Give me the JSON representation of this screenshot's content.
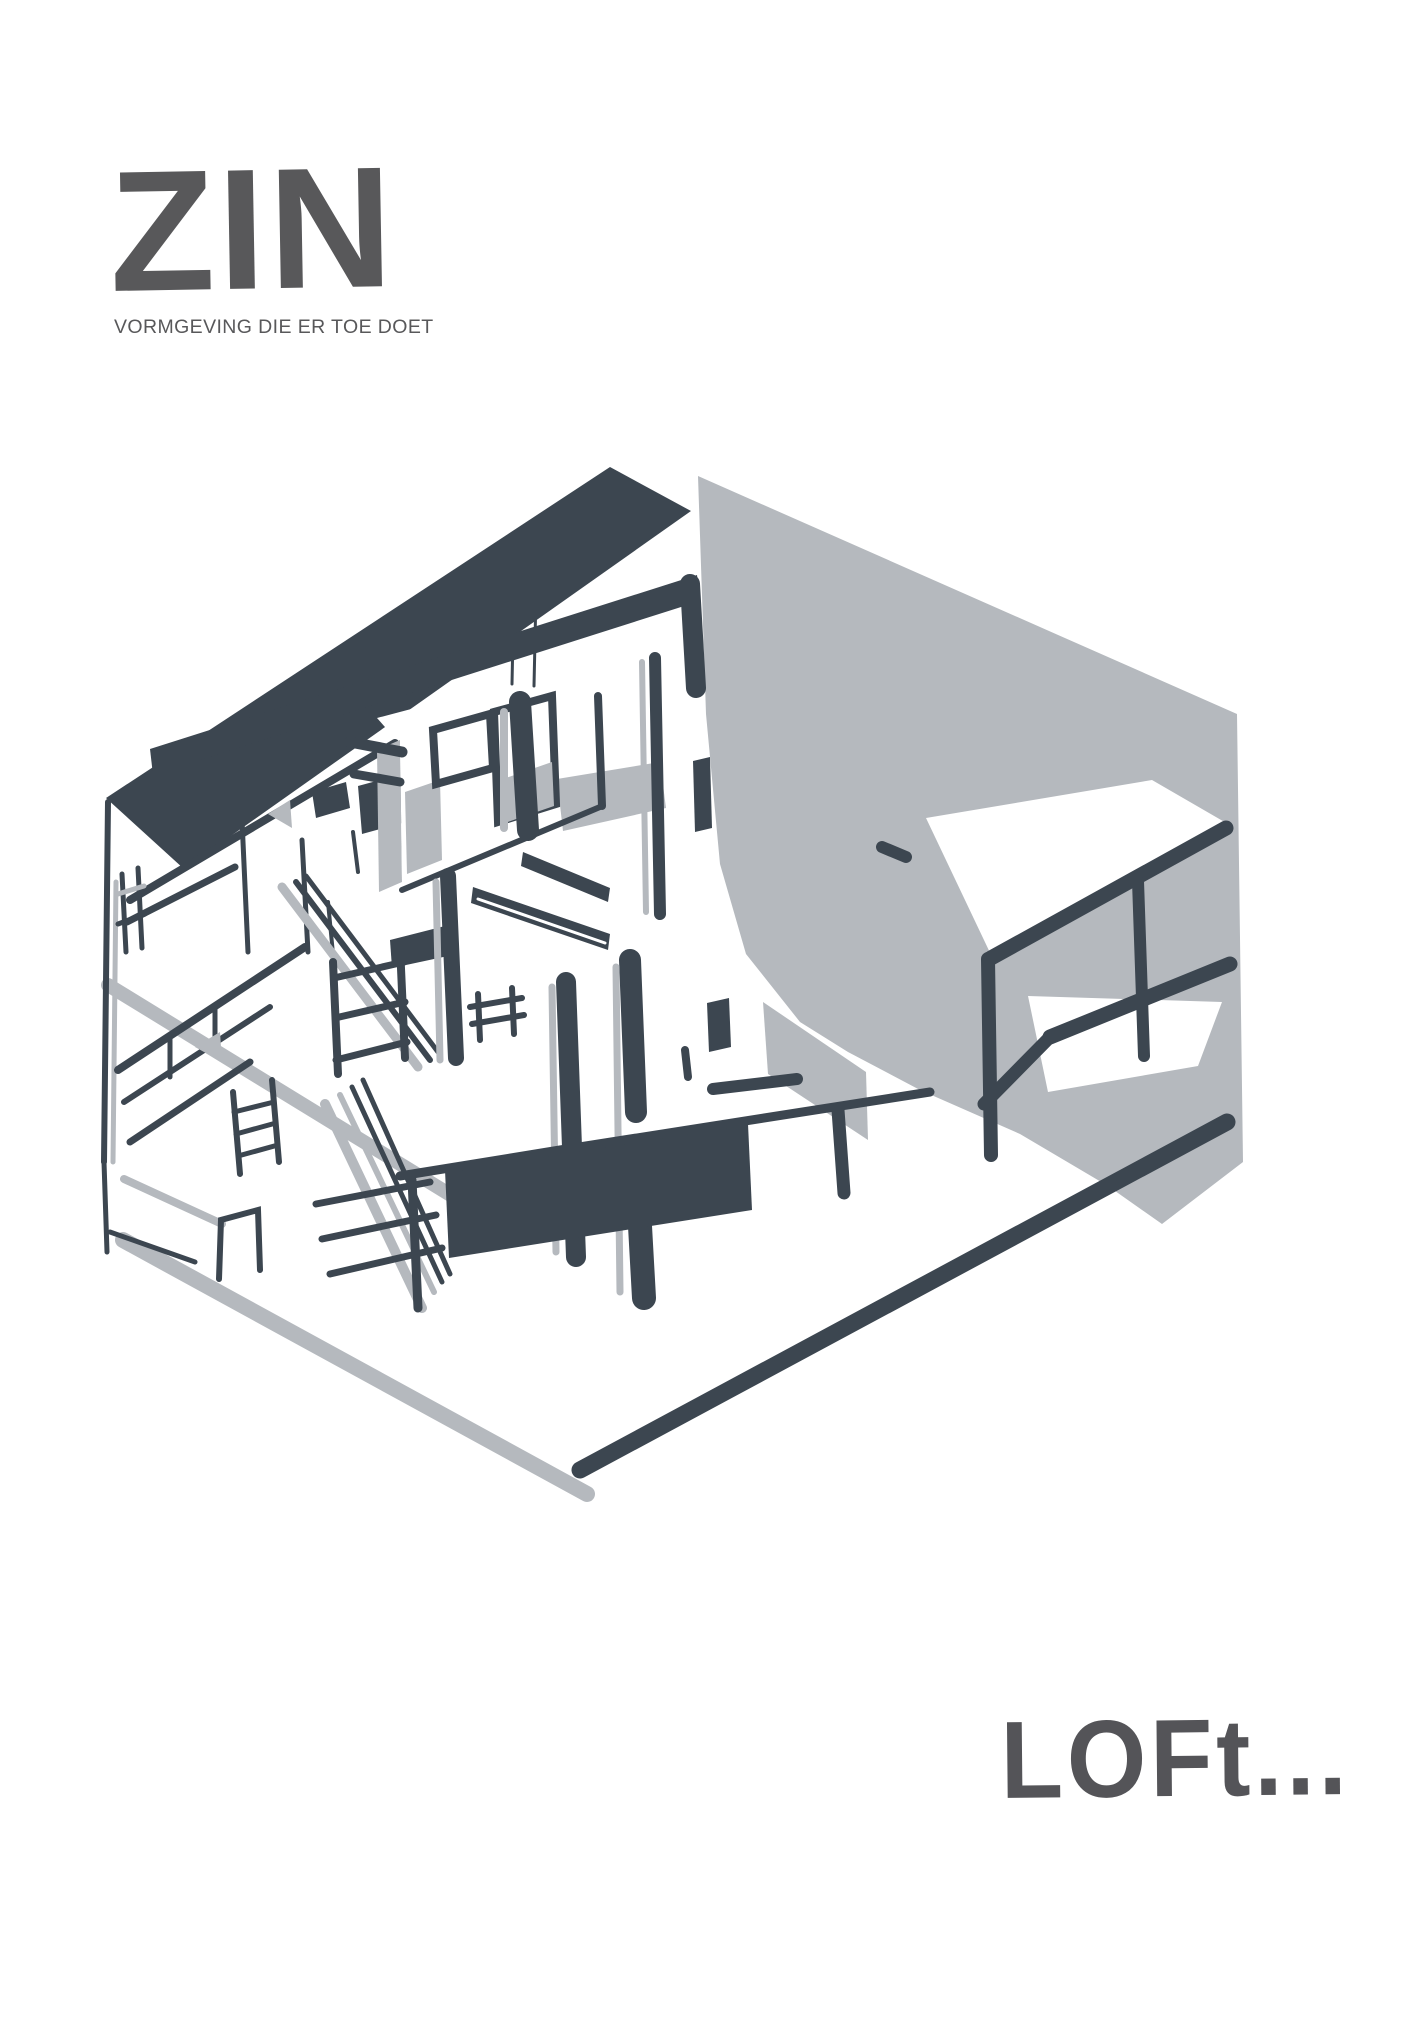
{
  "theme": {
    "page-bg": "#ffffff",
    "ink": "#3c4650",
    "mist": "#b5b9be",
    "logo-gray": "#58585a",
    "wordmark-gray": "#545458"
  },
  "logo": {
    "brand": "ZIN",
    "tagline": "VORMGEVING DIE ER TOE DOET"
  },
  "illustration": {
    "alt": "Hand-drawn axonometric cutaway sketch of a two-storey loft interior with open floors, stairs, slender columns, railings and built-in furniture, drawn in dark slate and light grey ink on white"
  },
  "footer": {
    "wordmark": "LOFt..."
  }
}
